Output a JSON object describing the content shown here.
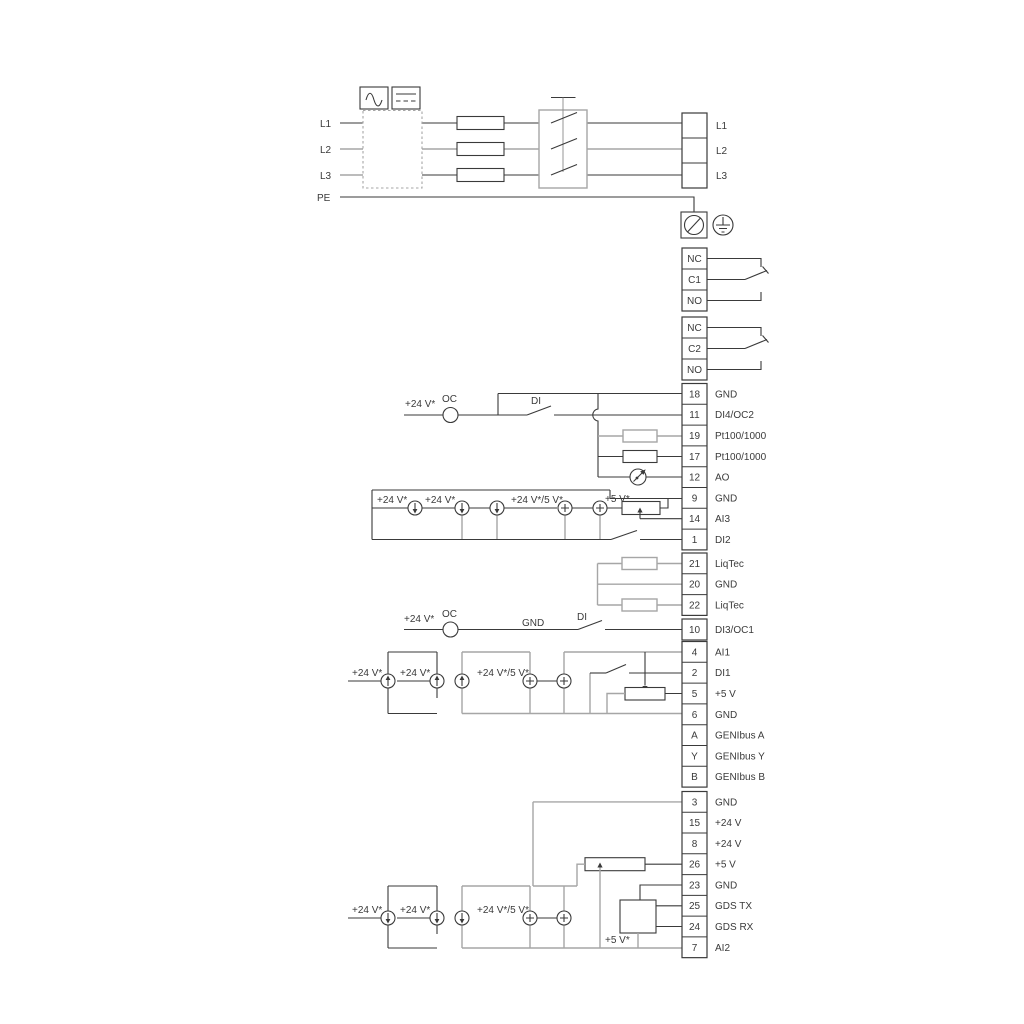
{
  "power": {
    "inputs": [
      "L1",
      "L2",
      "L3",
      "PE"
    ],
    "outputs": [
      "L1",
      "L2",
      "L3"
    ]
  },
  "relays": [
    {
      "terminals": [
        {
          "label": "NC"
        },
        {
          "label": "C1"
        },
        {
          "label": "NO"
        }
      ]
    },
    {
      "terminals": [
        {
          "label": "NC"
        },
        {
          "label": "C2"
        },
        {
          "label": "NO"
        }
      ]
    }
  ],
  "terminal_groups": {
    "io1": {
      "terminals": [
        {
          "no": "18",
          "label": "GND"
        },
        {
          "no": "11",
          "label": "DI4/OC2"
        },
        {
          "no": "19",
          "label": "Pt100/1000"
        },
        {
          "no": "17",
          "label": "Pt100/1000"
        },
        {
          "no": "12",
          "label": "AO"
        },
        {
          "no": "9",
          "label": "GND"
        },
        {
          "no": "14",
          "label": "AI3"
        },
        {
          "no": "1",
          "label": "DI2"
        }
      ]
    },
    "liqtec": {
      "terminals": [
        {
          "no": "21",
          "label": "LiqTec"
        },
        {
          "no": "20",
          "label": "GND"
        },
        {
          "no": "22",
          "label": "LiqTec"
        }
      ]
    },
    "di3oc1": {
      "terminals": [
        {
          "no": "10",
          "label": "DI3/OC1"
        }
      ]
    },
    "io2": {
      "terminals": [
        {
          "no": "4",
          "label": "AI1"
        },
        {
          "no": "2",
          "label": "DI1"
        },
        {
          "no": "5",
          "label": "+5 V"
        },
        {
          "no": "6",
          "label": "GND"
        },
        {
          "no": "A",
          "label": "GENIbus A"
        },
        {
          "no": "Y",
          "label": "GENIbus Y"
        },
        {
          "no": "B",
          "label": "GENIbus B"
        }
      ]
    },
    "io3": {
      "terminals": [
        {
          "no": "3",
          "label": "GND"
        },
        {
          "no": "15",
          "label": "+24 V"
        },
        {
          "no": "8",
          "label": "+24 V"
        },
        {
          "no": "26",
          "label": "+5 V"
        },
        {
          "no": "23",
          "label": "GND"
        },
        {
          "no": "25",
          "label": "GDS TX"
        },
        {
          "no": "24",
          "label": "GDS RX"
        },
        {
          "no": "7",
          "label": "AI2"
        }
      ]
    }
  },
  "annotations": {
    "di4_supply": "+24 V*",
    "di4_oc": "OC",
    "di4_di": "DI",
    "ai3_s1": "+24 V*",
    "ai3_s2": "+24 V*",
    "ai3_s3": "+24 V*/5 V*",
    "ai3_s4": "+5 V*",
    "di3_supply": "+24 V*",
    "di3_oc": "OC",
    "di3_gnd": "GND",
    "di3_di": "DI",
    "ai1_s1": "+24 V*",
    "ai1_s2": "+24 V*",
    "ai1_s3": "+24 V*/5 V*",
    "ai2_s1": "+24 V*",
    "ai2_s2": "+24 V*",
    "ai2_s3": "+24 V*/5 V*",
    "ai2_s4": "+5 V*"
  },
  "colors": {
    "line": "#3a3a3a",
    "line_alt": "#a6a6a6",
    "background": "#ffffff"
  }
}
